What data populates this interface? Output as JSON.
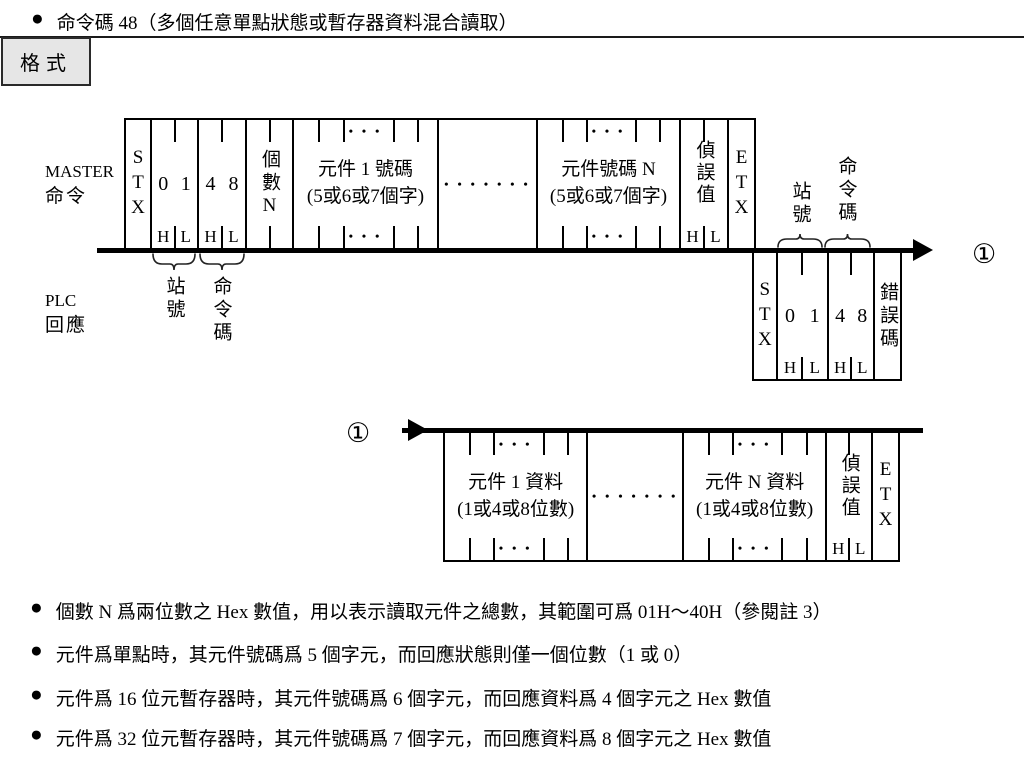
{
  "bullet": "●",
  "title": {
    "text": "命令碼 48（多個任意單點狀態或暫存器資料混合讀取）"
  },
  "format_tab": "格式",
  "labels": {
    "master_1": "MASTER",
    "master_2": "命令",
    "plc_1": "PLC",
    "plc_2": "回應",
    "station": "站號",
    "command": "命令碼",
    "marker": "①"
  },
  "master_frame": {
    "stx": "STX",
    "station_hi": "0",
    "station_lo": "1",
    "cmd_hi": "4",
    "cmd_lo": "8",
    "h": "H",
    "l": "L",
    "count": "個數N",
    "elem1_line1": "元件 1 號碼",
    "elem1_line2": "(5或6或7個字)",
    "elemN_line1": "元件號碼 N",
    "elemN_line2": "(5或6或7個字)",
    "check": "偵誤值",
    "etx": "ETX",
    "dots3": "• • •",
    "dots7": "• • • • • • •"
  },
  "response_frame": {
    "stx": "STX",
    "station_hi": "0",
    "station_lo": "1",
    "cmd_hi": "4",
    "cmd_lo": "8",
    "h": "H",
    "l": "L",
    "error": "錯誤碼"
  },
  "data_frame": {
    "elem1_line1": "元件 1 資料",
    "elem1_line2": "(1或4或8位數)",
    "elemN_line1": "元件 N 資料",
    "elemN_line2": "(1或4或8位數)",
    "check": "偵誤值",
    "etx": "ETX",
    "h": "H",
    "l": "L",
    "dots3": "• • •",
    "dots7": "• • • • • • •"
  },
  "notes": [
    "個數 N 爲兩位數之 Hex 數值，用以表示讀取元件之總數，其範圍可爲 01H～40H（參閱註 3）",
    "元件爲單點時，其元件號碼爲 5 個字元，而回應狀態則僅一個位數（1 或 0）",
    "元件爲 16 位元暫存器時，其元件號碼爲 6 個字元，而回應資料爲 4 個字元之 Hex 數值",
    "元件爲 32 位元暫存器時，其元件號碼爲 7 個字元，而回應資料爲 8 個字元之 Hex 數值"
  ]
}
